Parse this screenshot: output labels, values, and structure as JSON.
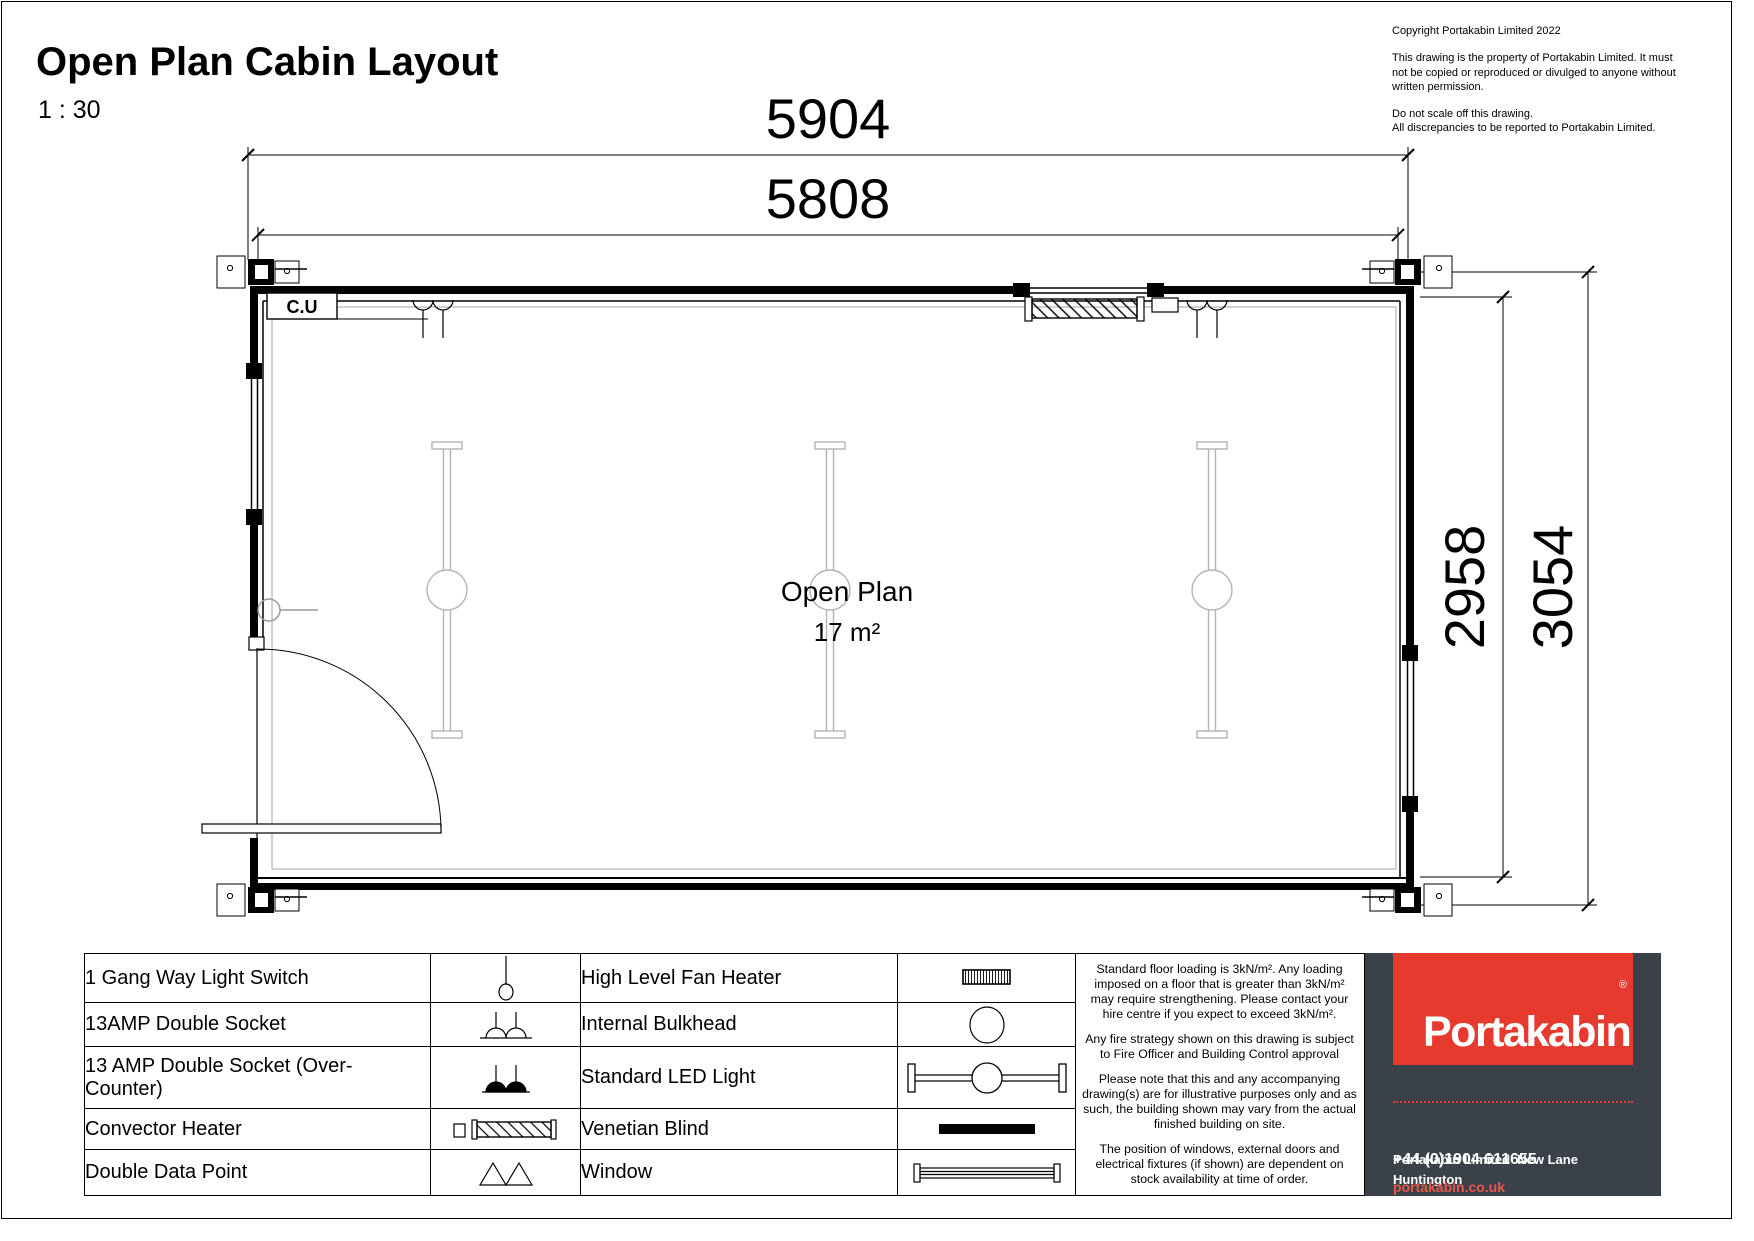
{
  "title": "Open Plan Cabin Layout",
  "scale": "1 : 30",
  "copyright": {
    "line1": "Copyright Portakabin Limited 2022",
    "para1": "This drawing is the property of Portakabin Limited. It must not be copied or reproduced or divulged to anyone without written permission.",
    "para2_line1": "Do not scale off this drawing.",
    "para2_line2": "All discrepancies to be reported to Portakabin Limited."
  },
  "plan": {
    "room_label": "Open Plan",
    "room_area": "17 m²",
    "cu_label": "C.U",
    "dimensions": {
      "top_outer": "5904",
      "top_inner": "5808",
      "right_inner": "2958",
      "right_outer": "3054"
    }
  },
  "legend": {
    "rows": [
      {
        "left_label": "1 Gang Way Light Switch",
        "left_icon": "pendant-light-switch-icon",
        "right_label": "High Level Fan Heater",
        "right_icon": "fan-heater-icon"
      },
      {
        "left_label": "13AMP Double Socket",
        "left_icon": "double-socket-icon",
        "right_label": "Internal Bulkhead",
        "right_icon": "bulkhead-circle-icon"
      },
      {
        "left_label": "13 AMP Double Socket (Over-Counter)",
        "left_icon": "double-socket-filled-icon",
        "right_label": "Standard LED Light",
        "right_icon": "led-light-icon"
      },
      {
        "left_label": "Convector Heater",
        "left_icon": "convector-heater-icon",
        "right_label": "Venetian Blind",
        "right_icon": "venetian-blind-icon"
      },
      {
        "left_label": "Double Data Point",
        "left_icon": "double-data-point-icon",
        "right_label": "Window",
        "right_icon": "window-icon"
      }
    ]
  },
  "notes": {
    "paragraphs": [
      "Standard floor loading is 3kN/m². Any loading imposed on a floor that is greater than 3kN/m² may require strengthening. Please contact your hire centre if you expect to exceed 3kN/m².",
      "Any fire strategy shown on this drawing is subject to Fire Officer and Building Control approval",
      "Please note that this and any accompanying drawing(s) are for illustrative purposes only and as such, the building shown may vary from the actual finished building on site.",
      "The position of windows, external doors and electrical fixtures (if shown) are dependent on stock availability at time of order."
    ]
  },
  "brand": {
    "logo_text": "Portakabin",
    "registered": "®",
    "address_line1": "Portakabin Limited  New Lane  Huntington",
    "address_line2": "York  YO32 9PT  United Kingdom",
    "phone": "+44 (0)1904 611655",
    "website": "portakabin.co.uk",
    "colors": {
      "brand_red": "#e63a2e",
      "panel_dark": "#3a4149"
    }
  }
}
